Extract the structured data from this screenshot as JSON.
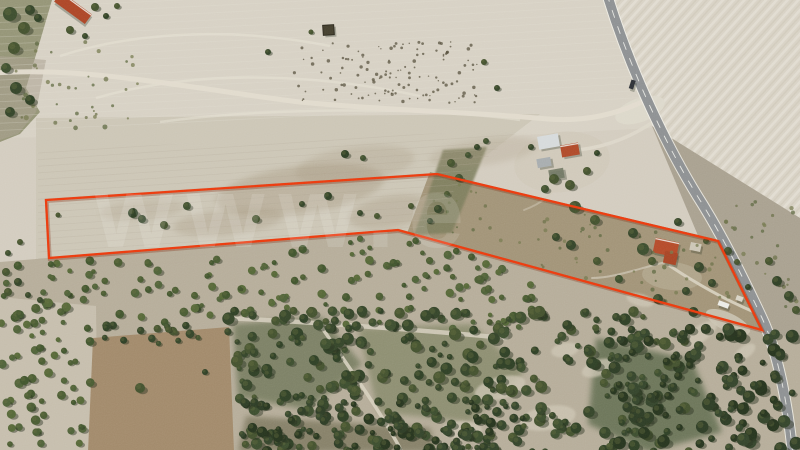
{
  "meta": {
    "title": "Aerial drone photograph of rural farmland parcel for sale, boundary outlined in red",
    "width": 800,
    "height": 450
  },
  "watermark": {
    "text": "www.e",
    "color": "#ffffff",
    "opacity": 0.12
  },
  "boundary": {
    "color": "#ec3a0f",
    "shadow_color": "#7e2206",
    "stroke_width": 2.3,
    "points": [
      [
        46,
        200
      ],
      [
        437,
        174
      ],
      [
        718,
        241
      ],
      [
        762,
        330
      ],
      [
        398,
        230
      ],
      [
        49,
        258
      ]
    ]
  },
  "palette": {
    "base_field": "#d3ccbf",
    "top_field": "#d7d1c4",
    "plowed": "#d8d2c5",
    "furrow_light": "#e9e5da",
    "furrow_dark": "#ccc5b5",
    "right_scrub": "#a9a190",
    "parcel_field": "#ccc6b6",
    "garden_area": "#a29478",
    "gully_green": "#7c7d5b",
    "left_strip": "#8f8f70",
    "bottom_band": "#b6ad9a",
    "bottomleft_pale": "#c6bead",
    "brown_field": "#a28a6b",
    "smudge": "#a3947b",
    "clearing": "#cdc6b4",
    "track": "#e1dbce",
    "road_asphalt": "#8e9193",
    "road_edge": "#f2f1ea",
    "road_line": "#f4f4ef",
    "plow_line_light": "#e4e0d4",
    "plow_line_dark": "#b5ad9c",
    "headland": "#e8e4d8",
    "shadow": "#273120",
    "vehicle_dark": "#2f3338"
  },
  "tree_shades": {
    "speckle": [
      "#57503e"
    ],
    "mid": [
      "#4a5c33",
      "#556838",
      "#41552e",
      "#4f6239"
    ],
    "dark": [
      "#35452a",
      "#3d4e2f",
      "#2f4026",
      "#44522f"
    ],
    "deep": [
      "#2e3d26",
      "#35452c",
      "#27351f"
    ],
    "weed": [
      "#6b7048",
      "#5e6840",
      "#767a4f"
    ]
  },
  "regions": [
    {
      "name": "base-field",
      "pts": [
        [
          0,
          0
        ],
        [
          800,
          0
        ],
        [
          800,
          450
        ],
        [
          0,
          450
        ]
      ],
      "fill": "base_field"
    },
    {
      "name": "top-field",
      "pts": [
        [
          0,
          0
        ],
        [
          618,
          0
        ],
        [
          652,
          128
        ],
        [
          470,
          138
        ],
        [
          300,
          132
        ],
        [
          0,
          138
        ]
      ],
      "fill": "top_field",
      "clip_id": "clipTop"
    },
    {
      "name": "plowed-field-right",
      "pts": [
        [
          610,
          0
        ],
        [
          800,
          0
        ],
        [
          800,
          225
        ],
        [
          652,
          126
        ]
      ],
      "fill": "plowed"
    },
    {
      "name": "plowed-field-furrows",
      "pts": [
        [
          610,
          0
        ],
        [
          800,
          0
        ],
        [
          800,
          225
        ],
        [
          652,
          126
        ]
      ],
      "fill": "pattern:furrows",
      "opacity": 0.55
    },
    {
      "name": "right-roadside-scrub",
      "pts": [
        [
          652,
          126
        ],
        [
          800,
          218
        ],
        [
          800,
          450
        ],
        [
          788,
          450
        ]
      ],
      "fill": "right_scrub"
    },
    {
      "name": "parcel-field",
      "pts": [
        [
          36,
          118
        ],
        [
          540,
          114
        ],
        [
          470,
          168
        ],
        [
          420,
          235
        ],
        [
          288,
          262
        ],
        [
          36,
          268
        ]
      ],
      "fill": "parcel_field"
    },
    {
      "name": "garden-area",
      "pts": [
        [
          430,
          172
        ],
        [
          720,
          240
        ],
        [
          764,
          332
        ],
        [
          556,
          282
        ],
        [
          406,
          236
        ]
      ],
      "fill": "garden_area"
    },
    {
      "name": "green-gully",
      "pts": [
        [
          443,
          150
        ],
        [
          487,
          147
        ],
        [
          452,
          233
        ],
        [
          414,
          235
        ]
      ],
      "fill": "gully_green",
      "opacity": 0.85,
      "blur": "b1"
    },
    {
      "name": "left-green-strip",
      "pts": [
        [
          0,
          0
        ],
        [
          52,
          0
        ],
        [
          38,
          48
        ],
        [
          26,
          88
        ],
        [
          40,
          112
        ],
        [
          20,
          134
        ],
        [
          0,
          142
        ]
      ],
      "fill": "left_strip",
      "opacity": 0.92
    },
    {
      "name": "left-scrub",
      "pts": [
        [
          0,
          56
        ],
        [
          46,
          60
        ],
        [
          36,
          112
        ],
        [
          18,
          134
        ],
        [
          0,
          140
        ]
      ],
      "fill": "right_scrub",
      "opacity": 0.55
    },
    {
      "name": "bottom-woodland-band",
      "pts": [
        [
          0,
          262
        ],
        [
          398,
          229
        ],
        [
          762,
          329
        ],
        [
          800,
          341
        ],
        [
          800,
          450
        ],
        [
          0,
          450
        ]
      ],
      "fill": "bottom_band"
    },
    {
      "name": "wood-dark-a",
      "pts": [
        [
          233,
          324
        ],
        [
          322,
          317
        ],
        [
          362,
          364
        ],
        [
          308,
          410
        ],
        [
          238,
          397
        ]
      ],
      "fill": "#6a7354",
      "opacity": 0.75,
      "blur": "b3"
    },
    {
      "name": "wood-dark-b",
      "pts": [
        [
          358,
          328
        ],
        [
          472,
          324
        ],
        [
          524,
          372
        ],
        [
          470,
          422
        ],
        [
          378,
          412
        ]
      ],
      "fill": "#747b58",
      "opacity": 0.6,
      "blur": "b3"
    },
    {
      "name": "wood-dark-c",
      "pts": [
        [
          596,
          338
        ],
        [
          692,
          360
        ],
        [
          722,
          432
        ],
        [
          648,
          452
        ],
        [
          588,
          424
        ]
      ],
      "fill": "#5c694b",
      "opacity": 0.8,
      "blur": "b3"
    },
    {
      "name": "wood-dark-d",
      "pts": [
        [
          246,
          416
        ],
        [
          430,
          428
        ],
        [
          436,
          452
        ],
        [
          238,
          452
        ]
      ],
      "fill": "#6e6b50",
      "opacity": 0.65,
      "blur": "b3"
    },
    {
      "name": "bottomleft-pale-field",
      "pts": [
        [
          0,
          297
        ],
        [
          96,
          306
        ],
        [
          98,
          452
        ],
        [
          0,
          452
        ]
      ],
      "fill": "bottomleft_pale"
    },
    {
      "name": "brown-cleared-field",
      "pts": [
        [
          93,
          338
        ],
        [
          229,
          327
        ],
        [
          234,
          452
        ],
        [
          88,
          452
        ]
      ],
      "fill": "brown_field"
    },
    {
      "name": "farm-yard",
      "ellipse": [
        562,
        162,
        48,
        30,
        -8
      ],
      "fill": "#cfc8b8",
      "opacity": 0.85
    },
    {
      "name": "road-junction-patch",
      "ellipse": [
        640,
        110,
        26,
        12,
        -20
      ],
      "fill": "#ddd8cb",
      "opacity": 0.9
    },
    {
      "name": "garden-dirt-patch",
      "ellipse": [
        672,
        276,
        30,
        14,
        5
      ],
      "fill": "#b3a88e",
      "opacity": 0.8
    },
    {
      "name": "roadside-sand-patch",
      "ellipse": [
        728,
        322,
        24,
        9,
        25
      ],
      "fill": "#c9c2b0",
      "opacity": 0.9
    }
  ],
  "smudges": {
    "color": "#a3947b",
    "items": [
      [
        300,
        190,
        85,
        24,
        -8,
        0.38
      ],
      [
        228,
        222,
        55,
        13,
        -6,
        0.3
      ],
      [
        142,
        210,
        42,
        10,
        -5,
        0.22
      ],
      [
        390,
        212,
        42,
        16,
        -10,
        0.32
      ],
      [
        484,
        152,
        55,
        13,
        -8,
        0.22
      ],
      [
        355,
        165,
        60,
        18,
        -8,
        0.25
      ]
    ]
  },
  "clearings": {
    "color": "#cdc6b4",
    "items": [
      [
        500,
        388,
        26,
        11,
        -15
      ],
      [
        548,
        418,
        28,
        12,
        -10
      ],
      [
        598,
        368,
        17,
        8,
        -20
      ],
      [
        462,
        430,
        20,
        9,
        0
      ],
      [
        640,
        300,
        14,
        6,
        15
      ],
      [
        700,
        334,
        20,
        8,
        -35
      ],
      [
        745,
        352,
        12,
        6,
        -35
      ],
      [
        565,
        350,
        14,
        7,
        -10
      ]
    ]
  },
  "tracks": [
    {
      "name": "dirt-track-main",
      "d": "M -6 73 C 90 66 200 90 300 102 C 392 111 472 112 548 119 C 588 122 618 113 642 102",
      "w": 5,
      "color": "#e1dbce",
      "opacity": 0.95
    },
    {
      "name": "farm-driveway",
      "d": "M 578 150 C 612 146 636 134 656 120",
      "w": 3.5,
      "color": "#ddd7ca",
      "opacity": 0.9
    },
    {
      "name": "garden-path",
      "d": "M 670 266 C 700 286 726 300 754 312",
      "w": 3,
      "color": "#d8d1c0",
      "opacity": 0.9
    },
    {
      "name": "garden-path-2",
      "d": "M 666 262 C 640 268 614 278 592 278",
      "w": 2,
      "color": "#cfc8b6",
      "opacity": 0.7
    },
    {
      "name": "farm-path-south",
      "d": "M 560 180 C 552 196 540 204 524 210",
      "w": 2,
      "color": "#cfc8b6",
      "opacity": 0.5
    },
    {
      "name": "woodland-track-horizontal",
      "d": "M 226 318 C 310 322 420 330 506 338",
      "w": 4.5,
      "color": "#d2cbba",
      "opacity": 0.9
    },
    {
      "name": "woodland-track-diagonal",
      "d": "M 318 322 C 344 360 380 410 402 452",
      "w": 3.5,
      "color": "#d6cfbe",
      "opacity": 0.9
    }
  ],
  "road": {
    "name": "asphalt-road",
    "d": "M 607 -6 C 630 70 668 150 703 205 C 722 236 742 275 762 318 C 778 352 788 406 793 456",
    "edge_width": 11.5,
    "width": 9.5,
    "center_dash": "8 9",
    "x_by_y": [
      [
        0,
        608
      ],
      [
        130,
        658
      ],
      [
        220,
        716
      ],
      [
        262,
        735
      ],
      [
        330,
        768
      ],
      [
        450,
        792
      ]
    ]
  },
  "buildings": [
    {
      "name": "barn-red-roof-topleft",
      "x": 54,
      "y": 2,
      "w": 38,
      "h": 12,
      "rot": 36,
      "fill": "#ad4627",
      "accent": "#ece9e2"
    },
    {
      "name": "ruin-square-structure",
      "x": 323,
      "y": 25,
      "w": 11,
      "h": 10,
      "rot": -4,
      "fill": "#45402f",
      "stroke": "#2e2a1f"
    },
    {
      "name": "farmhouse-white-roof",
      "x": 538,
      "y": 135,
      "w": 21,
      "h": 13,
      "rot": -10,
      "fill": "#d6dadb"
    },
    {
      "name": "farmhouse-red-roof",
      "x": 561,
      "y": 144,
      "w": 18,
      "h": 12,
      "rot": -10,
      "fill": "#b04a2a",
      "accent": "#e8e5de"
    },
    {
      "name": "farm-gray-shed",
      "x": 537,
      "y": 158,
      "w": 14,
      "h": 9,
      "rot": -10,
      "fill": "#a8adaf"
    },
    {
      "name": "farm-dark-structure",
      "x": 549,
      "y": 169,
      "w": 15,
      "h": 10,
      "rot": -10,
      "fill": "#707763",
      "opacity": 0.9
    },
    {
      "name": "parcel-house-red-roof",
      "x": 654,
      "y": 240,
      "w": 24,
      "h": 15,
      "rot": 12,
      "fill": "#b54b2a",
      "accent": "#e8e5de"
    },
    {
      "name": "parcel-house-wing",
      "x": 664,
      "y": 252,
      "w": 13,
      "h": 12,
      "rot": 12,
      "fill": "#a84526"
    },
    {
      "name": "parcel-shed",
      "x": 690,
      "y": 243,
      "w": 11,
      "h": 8,
      "rot": 12,
      "fill": "#ccc6b6"
    },
    {
      "name": "white-vehicle-parked",
      "x": 718,
      "y": 302,
      "w": 11,
      "h": 5,
      "rot": 20,
      "fill": "#ebebe6"
    },
    {
      "name": "small-hut-garden",
      "x": 736,
      "y": 296,
      "w": 7,
      "h": 5,
      "rot": 20,
      "fill": "#d9d4c6"
    },
    {
      "name": "vehicle-on-road",
      "x": 630,
      "y": 80,
      "w": 4.5,
      "h": 9,
      "rot": 18,
      "fill": "#2f3338"
    }
  ],
  "trees": [
    [
      133,
      213,
      5
    ],
    [
      142,
      219,
      4
    ],
    [
      164,
      225,
      4
    ],
    [
      187,
      206,
      4
    ],
    [
      256,
      219,
      4
    ],
    [
      302,
      204,
      3
    ],
    [
      328,
      196,
      4
    ],
    [
      360,
      213,
      3
    ],
    [
      377,
      216,
      3
    ],
    [
      411,
      206,
      3
    ],
    [
      345,
      154,
      4
    ],
    [
      363,
      158,
      3
    ],
    [
      58,
      215,
      2.5
    ],
    [
      20,
      242,
      3
    ],
    [
      8,
      253,
      3
    ],
    [
      451,
      163,
      4
    ],
    [
      459,
      178,
      4
    ],
    [
      447,
      194,
      3
    ],
    [
      438,
      209,
      4
    ],
    [
      430,
      221,
      3
    ],
    [
      468,
      155,
      3
    ],
    [
      477,
      147,
      3
    ],
    [
      486,
      141,
      3
    ],
    [
      575,
      207,
      6
    ],
    [
      595,
      220,
      5
    ],
    [
      643,
      249,
      6
    ],
    [
      652,
      261,
      4
    ],
    [
      699,
      267,
      5
    ],
    [
      712,
      283,
      4
    ],
    [
      686,
      291,
      4
    ],
    [
      658,
      299,
      5
    ],
    [
      619,
      279,
      4
    ],
    [
      597,
      261,
      4
    ],
    [
      571,
      245,
      5
    ],
    [
      556,
      237,
      4
    ],
    [
      633,
      233,
      5
    ],
    [
      678,
      222,
      4
    ],
    [
      728,
      251,
      4
    ],
    [
      737,
      262,
      3
    ],
    [
      706,
      241,
      3
    ],
    [
      748,
      287,
      3
    ],
    [
      554,
      179,
      5
    ],
    [
      570,
      185,
      5
    ],
    [
      587,
      171,
      4
    ],
    [
      545,
      189,
      4
    ],
    [
      597,
      153,
      3
    ],
    [
      531,
      147,
      3
    ],
    [
      777,
      281,
      5
    ],
    [
      789,
      296,
      5
    ],
    [
      769,
      261,
      4
    ],
    [
      796,
      310,
      4
    ],
    [
      268,
      52,
      3
    ],
    [
      484,
      62,
      3
    ],
    [
      497,
      88,
      3
    ],
    [
      311,
      32,
      2.5
    ],
    [
      10,
      14,
      7
    ],
    [
      24,
      28,
      6
    ],
    [
      14,
      48,
      6
    ],
    [
      30,
      10,
      5
    ],
    [
      6,
      68,
      5
    ],
    [
      16,
      88,
      6
    ],
    [
      30,
      100,
      5
    ],
    [
      10,
      112,
      5
    ],
    [
      38,
      18,
      4
    ],
    [
      95,
      7,
      4
    ],
    [
      106,
      16,
      3
    ],
    [
      117,
      6,
      3
    ],
    [
      70,
      30,
      4
    ],
    [
      85,
      36,
      3
    ],
    [
      6,
      272,
      4
    ],
    [
      18,
      282,
      4
    ],
    [
      8,
      292,
      4
    ],
    [
      28,
      295,
      3
    ],
    [
      40,
      300,
      3
    ],
    [
      140,
      388,
      5
    ],
    [
      205,
      372,
      3
    ]
  ],
  "scatter_bands": [
    {
      "name": "scrub-speckles",
      "x": [
        294,
        478
      ],
      "y": [
        42,
        103
      ],
      "count": 130,
      "r": [
        0.6,
        1.8
      ],
      "shade": "speckle"
    },
    {
      "name": "olive-grove-upper",
      "x": [
        0,
        532
      ],
      "y": [
        228,
        326
      ],
      "count": 200,
      "r": [
        2.2,
        4.4
      ],
      "shade": "mid",
      "rows": [
        13,
        0.42
      ],
      "keep": "below"
    },
    {
      "name": "olive-grove-left",
      "x": [
        0,
        96
      ],
      "y": [
        298,
        452
      ],
      "count": 60,
      "r": [
        2.4,
        4.8
      ],
      "shade": "mid",
      "rows": [
        14,
        0.42
      ]
    },
    {
      "name": "woodland-middle",
      "x": [
        226,
        700
      ],
      "y": [
        310,
        452
      ],
      "count": 320,
      "r": [
        2.6,
        6.2
      ],
      "shade": "dark",
      "exclude": [
        [
          88,
          327,
          236,
          452
        ]
      ]
    },
    {
      "name": "forest-right",
      "x": [
        612,
        798
      ],
      "y": [
        328,
        452
      ],
      "count": 110,
      "r": [
        3,
        6.8
      ],
      "shade": "deep"
    },
    {
      "name": "forest-bottom-dense",
      "x": [
        238,
        524
      ],
      "y": [
        402,
        452
      ],
      "count": 90,
      "r": [
        2.6,
        5.5
      ],
      "shade": "deep"
    },
    {
      "name": "garden-weeds",
      "x": [
        432,
        744
      ],
      "y": [
        180,
        326
      ],
      "count": 110,
      "r": [
        0.8,
        2.2
      ],
      "shade": "weed",
      "keep": "parcelRight"
    },
    {
      "name": "brown-field-border-trees",
      "x": [
        88,
        238
      ],
      "y": [
        324,
        344
      ],
      "count": 20,
      "r": [
        2.5,
        4.5
      ],
      "shade": "dark"
    },
    {
      "name": "roadside-scrub-dots",
      "x": [
        700,
        798
      ],
      "y": [
        200,
        330
      ],
      "count": 50,
      "r": [
        1,
        2.4
      ],
      "shade": "weed",
      "keep": "roadRight"
    },
    {
      "name": "left-scrub-dots",
      "x": [
        0,
        140
      ],
      "y": [
        40,
        130
      ],
      "count": 40,
      "r": [
        1,
        2.6
      ],
      "shade": "weed"
    }
  ],
  "random_seed": 77
}
